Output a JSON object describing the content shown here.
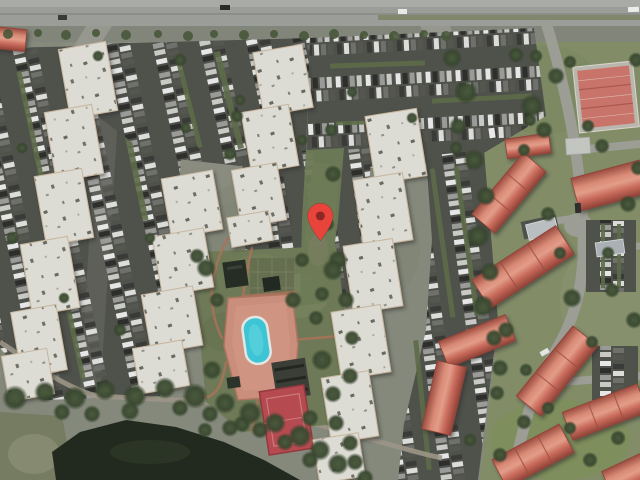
{
  "map": {
    "kind": "satellite-aerial-view",
    "marker": {
      "icon": "map-pin-icon",
      "x_px": 320,
      "y_px": 216,
      "tip_y_px": 241,
      "color": "#E8443B",
      "dot_color": "#8C2723"
    },
    "features": [
      "highway-top",
      "parking-lots",
      "white-roof-apartment-buildings",
      "red-roof-condo-buildings",
      "tennis-courts",
      "swimming-pool",
      "pool-deck",
      "sport-court",
      "pavilions",
      "carports",
      "pond",
      "shore-trees",
      "lawns",
      "map-pin"
    ]
  },
  "palette": {
    "ground": "#85897C",
    "road": "#9B9D98",
    "road_shoulder": "#A9ABA6",
    "asphalt": "#4F514B",
    "white_roof": "#DCDBD4",
    "roof_edge": "#C8B69D",
    "red_roof_mid": "#C96B5C",
    "red_roof_ridge": "#E29D89",
    "red_roof_eave": "#9A4B3F",
    "tree": "#3A4930",
    "lawn_right": "#828D68",
    "courtyard_lawn": "#6E7A57",
    "water": "#222A1F",
    "shore_grass": "#767C62",
    "pool_water": "#3EC5D5",
    "pool_deck": "#C98E7C",
    "sport_court": "#B54B50",
    "tennis_court": "#C9746A",
    "green_strip": "#5D6B49",
    "car_white": "#E6E6E6",
    "car_dark": "#2E2F2C",
    "car_gray": "#9A9A98",
    "car_silver": "#C9C9C6"
  }
}
